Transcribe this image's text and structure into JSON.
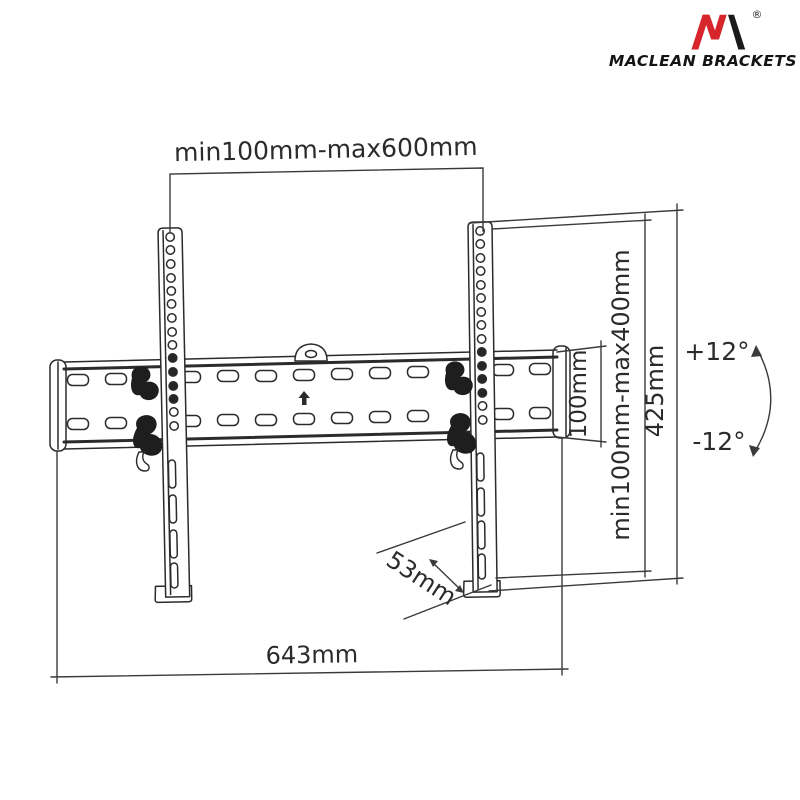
{
  "brand": {
    "name": "MACLEAN BRACKETS",
    "registered": "®",
    "colors": {
      "red": "#d6252b",
      "dark": "#1a1a1a"
    }
  },
  "labels": {
    "top_width": "min100mm-max600mm",
    "vesa_vertical": "min100mm-max400mm",
    "bracket_height": "425mm",
    "profile_height": "100mm",
    "depth": "53mm",
    "total_width": "643mm",
    "tilt_up": "+12°",
    "tilt_down": "-12°"
  },
  "style": {
    "line_color": "#2b2b2b",
    "dim_color": "#3a3a3a",
    "background": "#ffffff"
  }
}
